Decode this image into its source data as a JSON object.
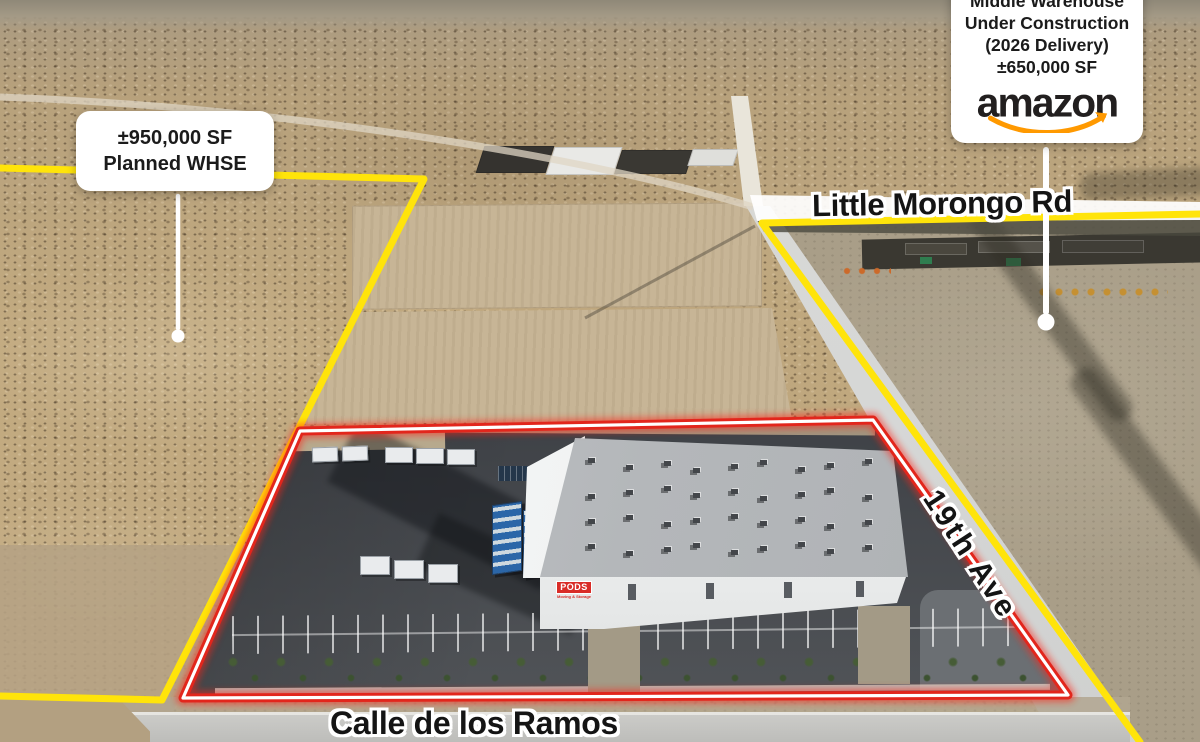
{
  "callouts": {
    "planned": {
      "line1": "±950,000 SF",
      "line2": "Planned WHSE"
    },
    "amazon": {
      "line1": "Middle Warehouse",
      "line2": "Under Construction",
      "line3": "(2026 Delivery)",
      "line4": "±650,000 SF",
      "brand": "amazon"
    }
  },
  "road_labels": {
    "little_morongo": "Little Morongo Rd",
    "nineteenth_ave": "19th Ave",
    "calle_de_los_ramos": "Calle de los Ramos"
  },
  "building": {
    "sign": "PODS",
    "tagline": "Moving & Storage"
  },
  "colors": {
    "boundary-yellow": "#FFE40A",
    "boundary-red": "#E2261C",
    "amazon-orange": "#FF9900",
    "pods-red": "#D92C27",
    "label-ink": "#141414"
  }
}
